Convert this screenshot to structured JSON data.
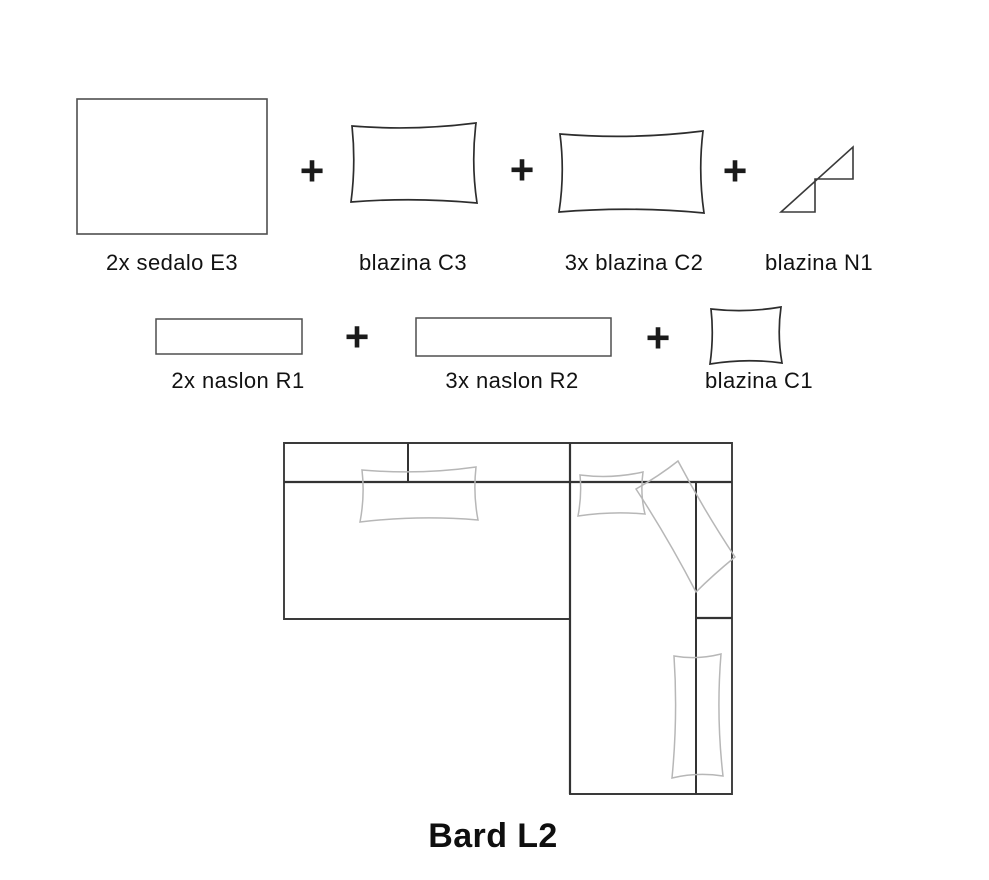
{
  "page": {
    "title": "Bard L2",
    "plus": "+"
  },
  "components_row1": {
    "sedalo_e3": "2x sedalo E3",
    "blazina_c3": "blazina C3",
    "blazina_c2": "3x blazina C2",
    "blazina_n1": "blazina N1"
  },
  "components_row2": {
    "naslon_r1": "2x naslon R1",
    "naslon_r2": "3x naslon R2",
    "blazina_c1": "blazina C1"
  },
  "icons": {
    "seat_shape": "plain-rectangle-outline",
    "cushion_shape": "pillow-outline",
    "neck_cushion_shape": "folded-wedge-outline",
    "backrest_shape": "thin-rectangle-outline",
    "diagram": "sofa-top-view-l-shape"
  },
  "colors": {
    "outline_dark": "#3a3a3a",
    "outline_medium": "#4f4f4f",
    "cushion_gray": "#b7b7b7",
    "text": "#121212",
    "background": "#ffffff"
  }
}
